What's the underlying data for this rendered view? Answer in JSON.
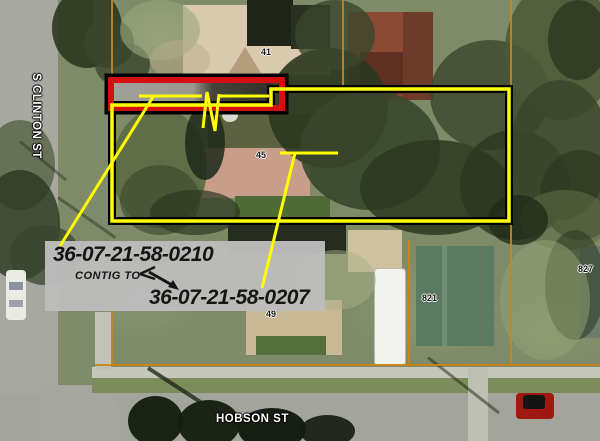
{
  "streets": {
    "vertical": "S CLINTON ST",
    "horizontal": "HOBSON ST"
  },
  "house_numbers": [
    {
      "id": "41",
      "text": "41"
    },
    {
      "id": "45",
      "text": "45"
    },
    {
      "id": "49",
      "text": "49"
    },
    {
      "id": "821",
      "text": "821"
    },
    {
      "id": "827",
      "text": "827"
    }
  ],
  "callout": {
    "parcel_top": "36-07-21-58-0210",
    "relation": "CONTIG TO",
    "parcel_bottom": "36-07-21-58-0207"
  },
  "colors": {
    "highlight_parcel_outline": "#ffff00",
    "highlight_strip_border": "#d40f0f",
    "outline_black": "#000000",
    "parcel_line": "#c8841a",
    "callout_background": "#bdbdbd",
    "callout_text": "#111111",
    "street_label": "#ffffff"
  }
}
